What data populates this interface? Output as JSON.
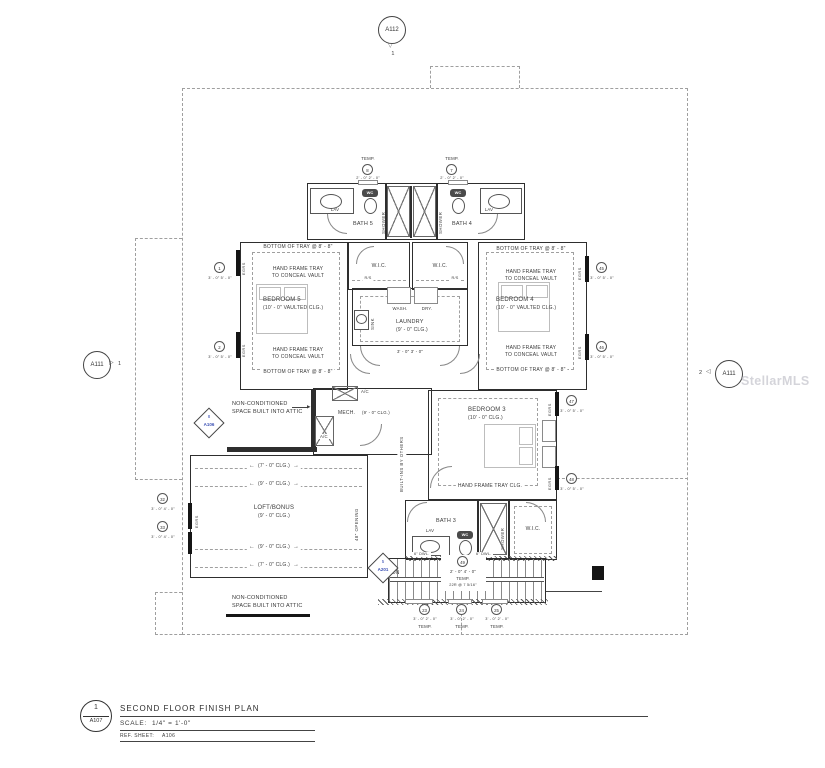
{
  "watermark": "StellarMLS",
  "colors": {
    "accent_blue": "#3d52b5",
    "line_dark": "#2e2e2e",
    "watermark_gray": "#b9b9c2"
  },
  "title_block": {
    "detail_num": "1",
    "detail_sheet": "A107",
    "title": "SECOND FLOOR FINISH PLAN",
    "scale_label": "SCALE:",
    "scale_value": "1/4\" = 1'-0\"",
    "ref_label": "REF. SHEET:",
    "ref_value": "A106"
  },
  "balloons": {
    "top": {
      "sheet": "A112",
      "num": "1"
    },
    "left": {
      "sheet": "A111",
      "num": "1"
    },
    "right": {
      "sheet": "A111",
      "num": "2"
    }
  },
  "detail_markers": {
    "mech": {
      "num": "8",
      "sheet": "A106"
    },
    "stair": {
      "num": "5",
      "sheet": "A201"
    }
  },
  "rooms": {
    "bath5": "BATH 5",
    "bath4": "BATH 4",
    "bath3": "BATH 3",
    "bedroom5": {
      "name": "BEDROOM 5",
      "ceiling": "(10' - 0\" VAULTED CLG.)"
    },
    "bedroom4": {
      "name": "BEDROOM 4",
      "ceiling": "(10' - 0\" VAULTED CLG.)"
    },
    "bedroom3": {
      "name": "BEDROOM 3",
      "ceiling": "(10' - 0\" CLG.)"
    },
    "laundry": {
      "name": "LAUNDRY",
      "ceiling": "(9' - 0\" CLG.)"
    },
    "mech": {
      "name": "MECH.",
      "ceiling": "(9' - 0\" CLG.)"
    },
    "loft": {
      "name": "LOFT/BONUS",
      "ceiling": "(9' - 0\" CLG.)"
    },
    "wic": "W.I.C."
  },
  "labels": {
    "lav": "LAV",
    "wc": "WC",
    "shower": "SHOWER",
    "sink": "SINK",
    "wash": "WASH.",
    "dry": "DRY.",
    "rod_shelf": "R/S",
    "ac": "A/C",
    "dn": "DN",
    "egress": "EGRS",
    "pony_wall": "6\" DWL.",
    "temp": "TEMP.",
    "riser_note": "22R @ 7 5/16\"",
    "built_ins": "BUILT-INS BY OTHERS",
    "opening": "48\" OPENING"
  },
  "notes": {
    "tray_bottom": "BOTTOM OF TRAY @ 8' - 8\"",
    "tray_line1": "HAND FRAME TRAY",
    "tray_line2": "TO CONCEAL VAULT",
    "tray_ceiling": "HAND FRAME TRAY CLG.",
    "attic_line1": "NON-CONDITIONED",
    "attic_line2": "SPACE BUILT INTO ATTIC",
    "ceiling_7": "(7' - 0\" CLG.)",
    "ceiling_9": "(9' - 0\" CLG.)"
  },
  "window_tags": {
    "w8": {
      "num": "8",
      "dim": "2' - 0\" 2' - 0\""
    },
    "w7": {
      "num": "7",
      "dim": "2' - 0\" 2' - 0\""
    },
    "w1": {
      "num": "1",
      "dim": "3' - 0\" 5' - 0\""
    },
    "w2": {
      "num": "2",
      "dim": "3' - 0\" 5' - 0\""
    },
    "w45": {
      "num": "45",
      "dim": "3' - 0\" 5' - 0\""
    },
    "w46": {
      "num": "46",
      "dim": "3' - 0\" 5' - 0\""
    },
    "w47": {
      "num": "47",
      "dim": "3' - 0\" 5' - 0\""
    },
    "w48": {
      "num": "48",
      "dim": "3' - 0\" 5' - 0\""
    },
    "w32": {
      "num": "32",
      "dim": "3' - 0\" 4' - 0\""
    },
    "w33": {
      "num": "33",
      "dim": "3' - 0\" 4' - 0\""
    },
    "w23": {
      "num": "23",
      "dim": "3' - 0\" 2' - 0\""
    },
    "w24": {
      "num": "24",
      "dim": "3' - 0\" 2' - 0\""
    },
    "w25": {
      "num": "25",
      "dim": "3' - 0\" 2' - 0\""
    },
    "w49": {
      "num": "49",
      "dim": "2' - 0\" 4' - 0\""
    }
  },
  "dimensions": {
    "laundry_doors": "3' - 0\" 3' - 0\""
  }
}
